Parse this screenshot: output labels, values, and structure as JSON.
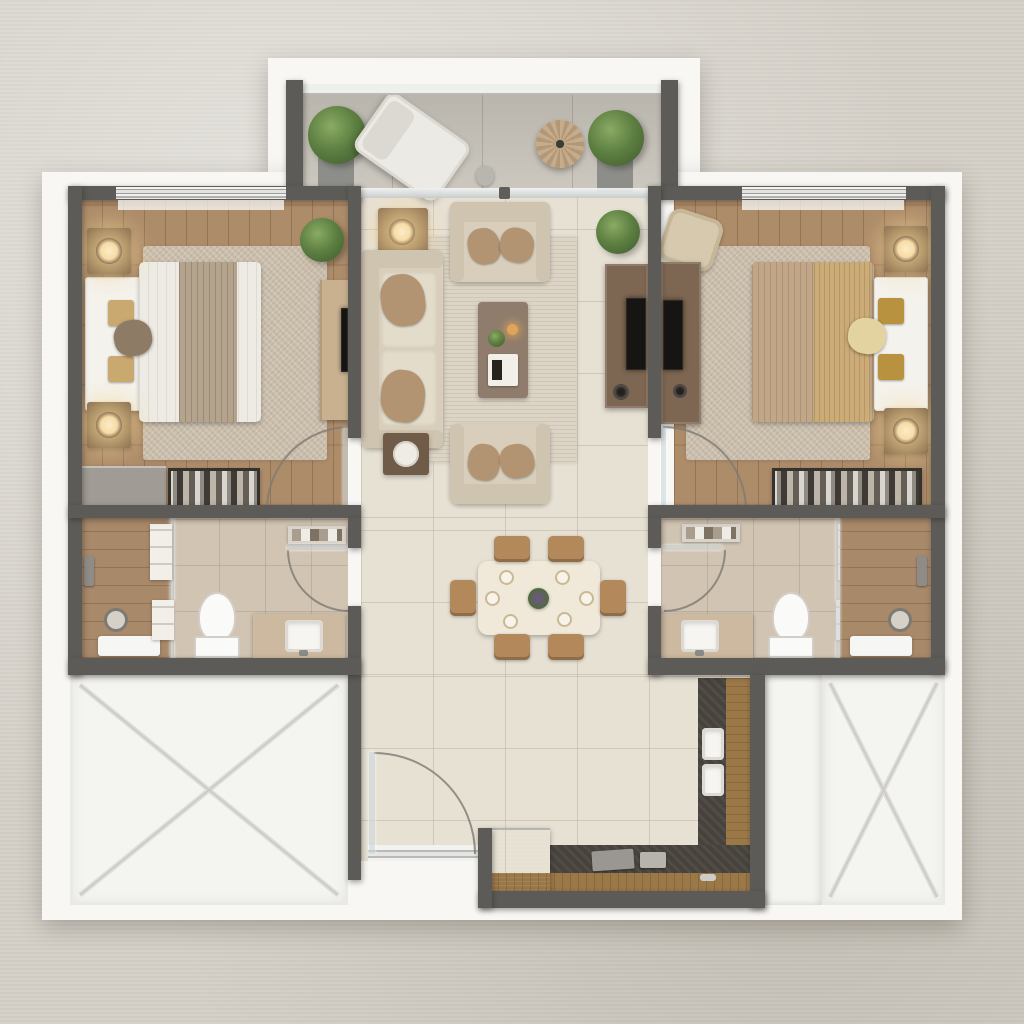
{
  "scene": {
    "kind": "residential-apartment-floor-plan",
    "view": "top-down-3d-render",
    "visible_text": "none",
    "summary": {
      "bedrooms": 2,
      "bathrooms": 2,
      "balconies": 1,
      "dining_seats": 6,
      "void_areas": 2
    }
  },
  "palette": {
    "bg": "#d5d1c9",
    "slab": "#f8f7f4",
    "wall": "#5c5b57",
    "woodFloor": "#a98662",
    "tileFloor": "#e7e1d4",
    "balconyTile": "#c8c4bb",
    "bathTile": "#d1c4b2",
    "showerWood": "#a8896a",
    "rugBedroom": "#cabdab",
    "rugLiving": "#dcd4c5",
    "sofaBeige": "#d8cebb",
    "cushionTan": "#b29472",
    "coffeeTable": "#8f7c6c",
    "consoleBrown": "#7e6752",
    "tvBlack": "#171513",
    "diningTable": "#f0e9d9",
    "chairTan": "#b3895c",
    "counterDark": "#47423c",
    "counterWood": "#9b7848",
    "applianceGray": "#90908e",
    "voidWhite": "#f4f4f1",
    "lampGlow": "#f6dca6",
    "plantGreen": "#5f8143",
    "bedWhite": "#edebe4",
    "runnerTaupe": "#b4a48d",
    "bedTan": "#c1a687",
    "throwGold": "#cbab77",
    "vanityBeige": "#cdb9a0",
    "porcelain": "#fafaf8",
    "silver": "#d8d8d4",
    "woodFurniture": "#7b6148",
    "closetDark": "#2c2926",
    "dresserGray": "#a09b94",
    "benchWhite": "#f4f2ec"
  },
  "rooms": [
    {
      "id": "balcony",
      "items": [
        "potted-plant",
        "lounge-chair",
        "round-side-table",
        "potted-plant",
        "railing",
        "sliding-glass-door"
      ]
    },
    {
      "id": "bedroom-left",
      "items": [
        "double-bed",
        "headboard-bench",
        "nightstand-lamp",
        "nightstand-lamp",
        "area-rug",
        "wardrobe",
        "wall-tv",
        "dresser",
        "open-closet",
        "potted-plant",
        "window",
        "hinged-door"
      ]
    },
    {
      "id": "living-room",
      "items": [
        "sofa",
        "armchair",
        "armchair",
        "coffee-table",
        "side-table-lamp",
        "side-table",
        "tv-console",
        "tv",
        "speaker",
        "area-rug",
        "potted-plant"
      ]
    },
    {
      "id": "bedroom-right",
      "items": [
        "double-bed",
        "headboard-bench",
        "nightstand-lamp",
        "nightstand-lamp",
        "area-rug",
        "corner-armchair",
        "tv-console",
        "tv",
        "open-closet",
        "window",
        "hinged-door"
      ]
    },
    {
      "id": "dining-area",
      "items": [
        "dining-table",
        "dining-chair",
        "dining-chair",
        "dining-chair",
        "dining-chair",
        "dining-chair",
        "dining-chair",
        "place-setting-x6",
        "centerpiece"
      ]
    },
    {
      "id": "bathroom-left",
      "items": [
        "walk-in-shower",
        "glass-partition",
        "shower-head",
        "shower-tray",
        "toilet",
        "vanity-sink",
        "shelving",
        "towel-shelf",
        "hinged-door"
      ]
    },
    {
      "id": "bathroom-right",
      "items": [
        "walk-in-shower",
        "glass-partition",
        "shower-head",
        "shower-tray",
        "toilet",
        "vanity-sink",
        "shelving",
        "towel-shelf",
        "hinged-door"
      ]
    },
    {
      "id": "hallway-entrance",
      "items": [
        "entry-door",
        "door-arc",
        "threshold"
      ]
    },
    {
      "id": "kitchen",
      "items": [
        "l-shaped-counter",
        "double-basin",
        "trays",
        "appliance"
      ]
    },
    {
      "id": "void-left",
      "items": [
        "x-marking"
      ]
    },
    {
      "id": "void-right",
      "items": [
        "x-marking"
      ]
    }
  ]
}
